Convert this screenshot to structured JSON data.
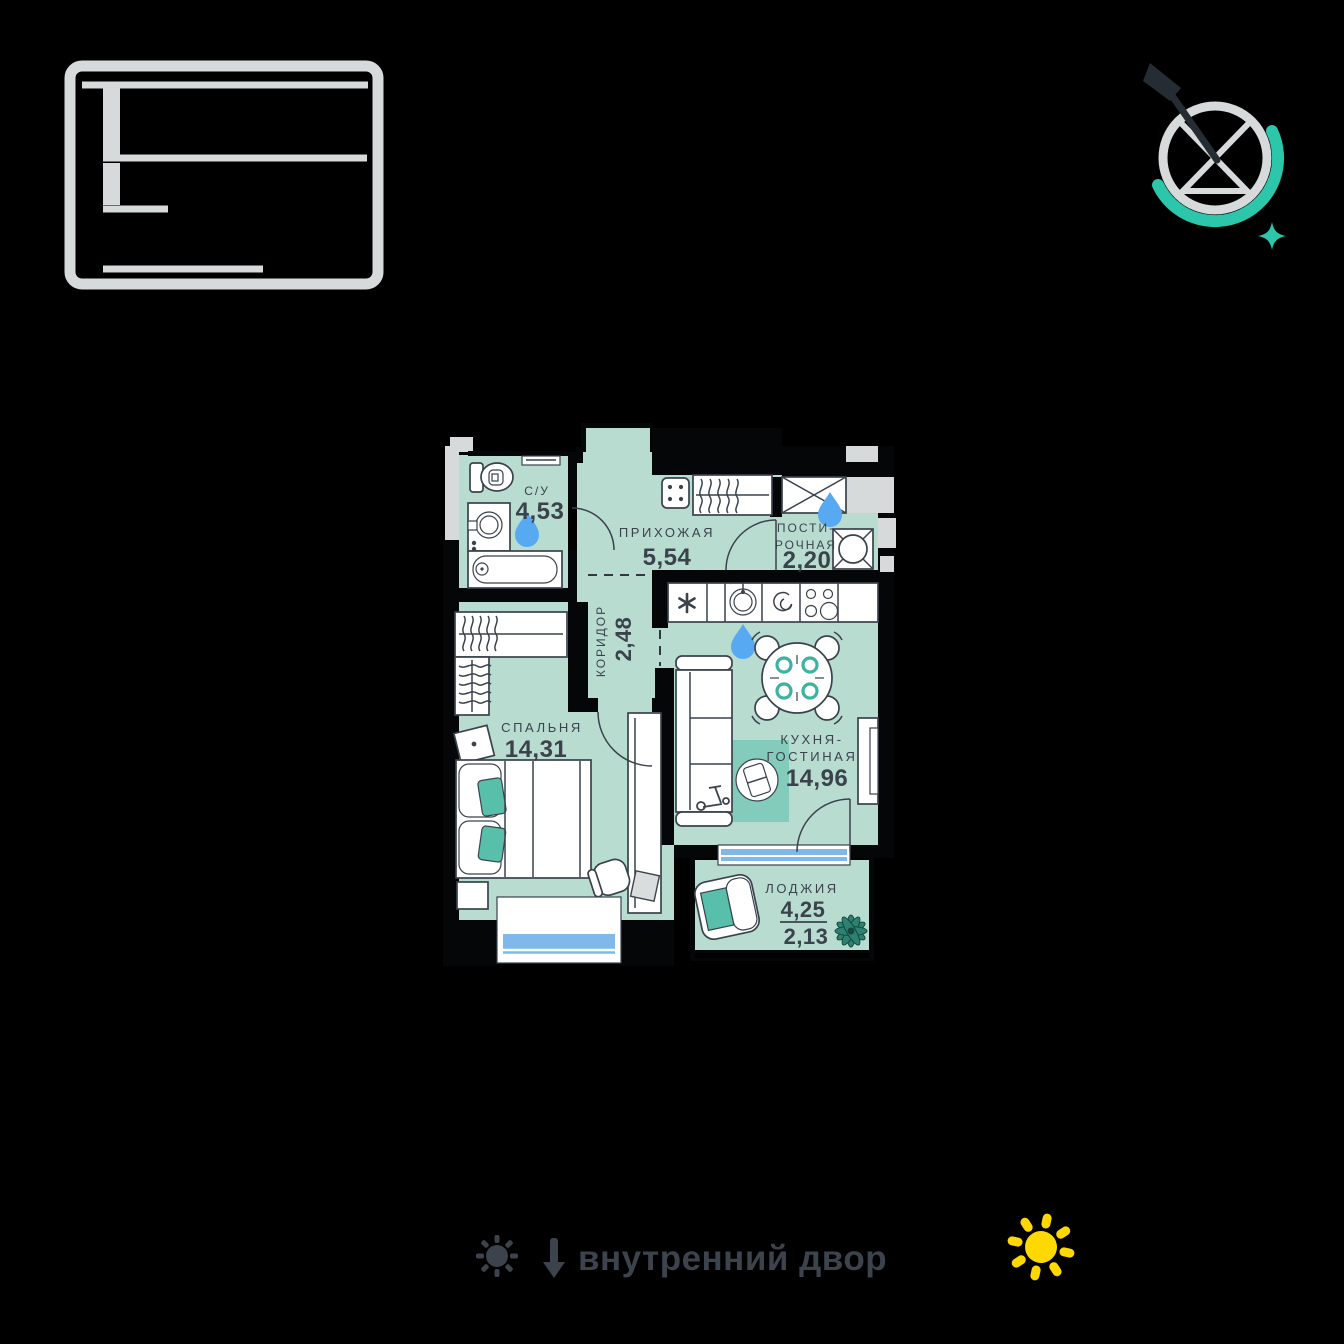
{
  "plan": {
    "rooms": {
      "bathroom": {
        "label": "С/У",
        "area": "4,53"
      },
      "hallway": {
        "label": "ПРИХОЖАЯ",
        "area": "5,54"
      },
      "laundry": {
        "label_line1": "ПОСТИ-",
        "label_line2": "РОЧНАЯ",
        "area": "2,20"
      },
      "corridor": {
        "label": "КОРИДОР",
        "area": "2,48"
      },
      "bedroom": {
        "label": "СПАЛЬНЯ",
        "area": "14,31"
      },
      "kitchen_living": {
        "label_line1": "КУХНЯ-",
        "label_line2": "ГОСТИНАЯ",
        "area": "14,96"
      },
      "loggia": {
        "label": "ЛОДЖИЯ",
        "area_total": "4,25",
        "area_reduced": "2,13"
      }
    }
  },
  "footer": {
    "caption": "внутренний двор"
  },
  "icons": {
    "building_schematic": "building-section-schematic",
    "compass": "compass-with-north-needle",
    "compass_star": "teal-sparkle-star",
    "sun_small_gray": "sun-icon",
    "arrow_down": "down-arrow-icon",
    "sun_yellow": "sun-icon",
    "water_drop": "water-drop-icon",
    "plant": "plant-icon"
  },
  "colors": {
    "room_fill": "#b9dcd1",
    "rug": "#83cbbb",
    "cushion": "#58bfab",
    "plate_ring": "#3cb2a0",
    "water_drop": "#57a9f2",
    "window_glass": "#7fb9ec",
    "accent_teal": "#2cc6ab",
    "sun_yellow": "#ffd800",
    "wall": "#050607",
    "outline": "#3a424c",
    "exterior_gray": "#d6dada",
    "footer_text": "#3c434c"
  }
}
